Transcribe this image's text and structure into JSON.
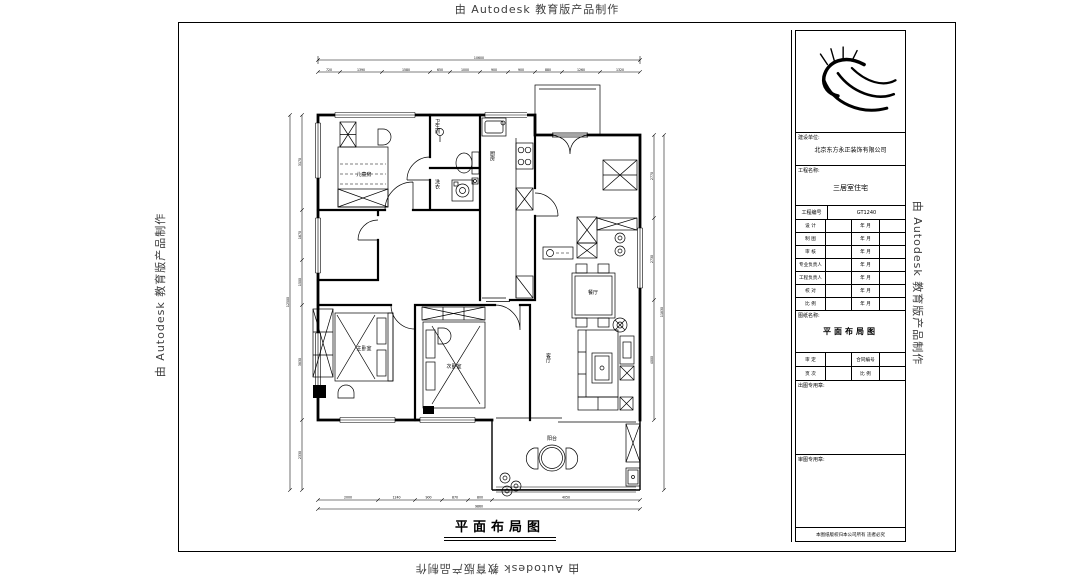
{
  "watermark": {
    "text": "由 Autodesk 教育版产品制作"
  },
  "plan": {
    "title": "平面布局图",
    "rooms": {
      "bedroom1": "儿童房",
      "bathroom": "卫生间",
      "laundry": "洗衣",
      "kitchen": "厨房",
      "dining": "餐厅",
      "living": "客厅",
      "master": "主卧室",
      "bedroom2": "次卧室",
      "balcony": "阳台"
    },
    "dims": {
      "top_total": "10600",
      "top": [
        "720",
        "1390",
        "1580",
        "650",
        "1000",
        "900",
        "900",
        "880",
        "1260",
        "1320"
      ],
      "left_total": "12500",
      "left": [
        "3170",
        "1670",
        "1500",
        "3830",
        "2330"
      ],
      "right_total": "11830",
      "right": [
        "2770",
        "2730",
        "4000"
      ],
      "bottom": [
        "2000",
        "1240",
        "900",
        "870",
        "800",
        "4050"
      ],
      "bottom_total": "9860"
    }
  },
  "titleblock": {
    "client_label": "建设单位:",
    "client_value": "北京东方永正装饰有限公司",
    "project_label": "工程名称:",
    "project_value": "三居室住宅",
    "table": {
      "header": [
        "工程编号",
        "GT1240"
      ],
      "rows": [
        [
          "设 计",
          "年 月"
        ],
        [
          "制 图",
          "年 月"
        ],
        [
          "审 核",
          "年 月"
        ],
        [
          "专业负责人",
          "年 月"
        ],
        [
          "工程负责人",
          "年 月"
        ],
        [
          "校 对",
          "年 月"
        ],
        [
          "比 例",
          "年 月"
        ]
      ]
    },
    "name_label": "图纸名称:",
    "name_value": "平面布局图",
    "row_a": [
      "审 定",
      "合同编号"
    ],
    "row_b": [
      "页 次",
      "比 例"
    ],
    "stamp1_label": "出图专用章:",
    "stamp2_label": "审图专用章:",
    "footer": "本图纸版权归本公司所有 违者必究"
  }
}
